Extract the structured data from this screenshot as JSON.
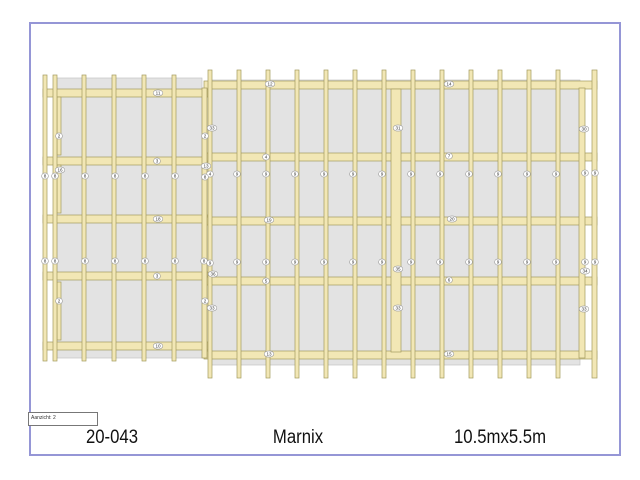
{
  "page": {
    "border_color": "#9596d6",
    "background_color": "#ffffff"
  },
  "title_block": {
    "view_label": "Aanzicht: 2",
    "project_number": "20-043",
    "project_name": "Marnix",
    "dimensions": "10.5mx5.5m"
  },
  "drawing": {
    "colors": {
      "wood_fill": "#f2e7b5",
      "wood_stroke": "#a39a5e",
      "panel_fill": "#e3e3e3",
      "panel_stroke": "#c2c2c2",
      "label_fill": "#ffffff",
      "label_stroke": "#999999",
      "label_text": "#333333"
    },
    "part_labels": [
      {
        "text": "11",
        "x": 158,
        "y": 93
      },
      {
        "text": "3",
        "x": 157,
        "y": 161
      },
      {
        "text": "18",
        "x": 158,
        "y": 219
      },
      {
        "text": "3",
        "x": 157,
        "y": 276
      },
      {
        "text": "10",
        "x": 158,
        "y": 346
      },
      {
        "text": "2",
        "x": 59,
        "y": 136
      },
      {
        "text": "16",
        "x": 60,
        "y": 170
      },
      {
        "text": "2",
        "x": 59,
        "y": 301
      },
      {
        "text": "8",
        "x": 45,
        "y": 176
      },
      {
        "text": "8",
        "x": 55,
        "y": 176
      },
      {
        "text": "8",
        "x": 85,
        "y": 176
      },
      {
        "text": "8",
        "x": 115,
        "y": 176
      },
      {
        "text": "8",
        "x": 145,
        "y": 176
      },
      {
        "text": "8",
        "x": 175,
        "y": 176
      },
      {
        "text": "8",
        "x": 45,
        "y": 261
      },
      {
        "text": "8",
        "x": 55,
        "y": 261
      },
      {
        "text": "8",
        "x": 85,
        "y": 261
      },
      {
        "text": "8",
        "x": 115,
        "y": 261
      },
      {
        "text": "8",
        "x": 145,
        "y": 261
      },
      {
        "text": "8",
        "x": 175,
        "y": 261
      },
      {
        "text": "33",
        "x": 212,
        "y": 128
      },
      {
        "text": "2",
        "x": 205,
        "y": 136
      },
      {
        "text": "13",
        "x": 206,
        "y": 166
      },
      {
        "text": "4",
        "x": 210,
        "y": 174
      },
      {
        "text": "8",
        "x": 205,
        "y": 177
      },
      {
        "text": "8",
        "x": 204,
        "y": 261
      },
      {
        "text": "9",
        "x": 210,
        "y": 263
      },
      {
        "text": "36",
        "x": 213,
        "y": 274
      },
      {
        "text": "2",
        "x": 205,
        "y": 301
      },
      {
        "text": "33",
        "x": 212,
        "y": 308
      },
      {
        "text": "12",
        "x": 270,
        "y": 84
      },
      {
        "text": "14",
        "x": 449,
        "y": 84
      },
      {
        "text": "4",
        "x": 266,
        "y": 157
      },
      {
        "text": "7",
        "x": 449,
        "y": 156
      },
      {
        "text": "19",
        "x": 269,
        "y": 220
      },
      {
        "text": "20",
        "x": 452,
        "y": 219
      },
      {
        "text": "5",
        "x": 266,
        "y": 281
      },
      {
        "text": "6",
        "x": 449,
        "y": 280
      },
      {
        "text": "13",
        "x": 269,
        "y": 354
      },
      {
        "text": "15",
        "x": 449,
        "y": 354
      },
      {
        "text": "31",
        "x": 398,
        "y": 128
      },
      {
        "text": "35",
        "x": 398,
        "y": 269
      },
      {
        "text": "33",
        "x": 398,
        "y": 308
      },
      {
        "text": "30",
        "x": 584,
        "y": 129
      },
      {
        "text": "34",
        "x": 585,
        "y": 271
      },
      {
        "text": "33",
        "x": 584,
        "y": 309
      },
      {
        "text": "9",
        "x": 237,
        "y": 174
      },
      {
        "text": "9",
        "x": 266,
        "y": 174
      },
      {
        "text": "9",
        "x": 295,
        "y": 174
      },
      {
        "text": "9",
        "x": 324,
        "y": 174
      },
      {
        "text": "9",
        "x": 353,
        "y": 174
      },
      {
        "text": "9",
        "x": 382,
        "y": 174
      },
      {
        "text": "9",
        "x": 411,
        "y": 174
      },
      {
        "text": "9",
        "x": 440,
        "y": 174
      },
      {
        "text": "9",
        "x": 469,
        "y": 174
      },
      {
        "text": "9",
        "x": 498,
        "y": 174
      },
      {
        "text": "9",
        "x": 527,
        "y": 174
      },
      {
        "text": "9",
        "x": 556,
        "y": 174
      },
      {
        "text": "9",
        "x": 585,
        "y": 173
      },
      {
        "text": "9",
        "x": 595,
        "y": 173
      },
      {
        "text": "9",
        "x": 237,
        "y": 262
      },
      {
        "text": "9",
        "x": 266,
        "y": 262
      },
      {
        "text": "9",
        "x": 295,
        "y": 262
      },
      {
        "text": "9",
        "x": 324,
        "y": 262
      },
      {
        "text": "9",
        "x": 353,
        "y": 262
      },
      {
        "text": "9",
        "x": 382,
        "y": 262
      },
      {
        "text": "9",
        "x": 411,
        "y": 262
      },
      {
        "text": "9",
        "x": 440,
        "y": 262
      },
      {
        "text": "9",
        "x": 469,
        "y": 262
      },
      {
        "text": "9",
        "x": 498,
        "y": 262
      },
      {
        "text": "9",
        "x": 527,
        "y": 262
      },
      {
        "text": "9",
        "x": 556,
        "y": 262
      },
      {
        "text": "9",
        "x": 585,
        "y": 262
      },
      {
        "text": "9",
        "x": 595,
        "y": 262
      }
    ]
  }
}
